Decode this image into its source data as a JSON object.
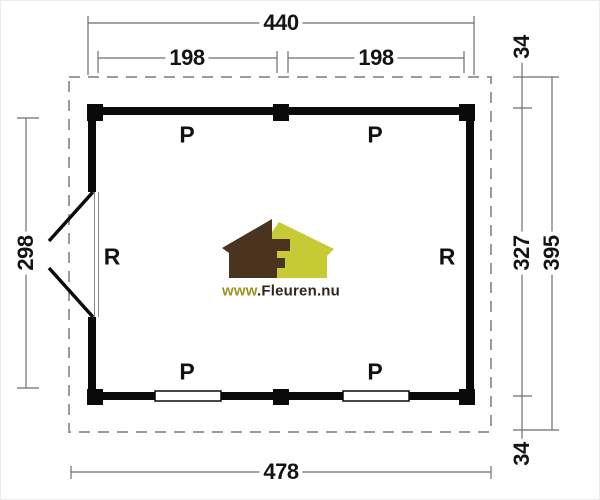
{
  "plan": {
    "dims": {
      "top_total": "440",
      "bay_left": "198",
      "bay_right": "198",
      "bottom_total": "478",
      "left_inner": "298",
      "right_overhang_top": "34",
      "right_wall": "327",
      "right_total": "395",
      "right_overhang_bottom": "34"
    },
    "labels": {
      "p_top_left": "P",
      "p_top_right": "P",
      "p_bottom_left": "P",
      "p_bottom_right": "P",
      "r_left": "R",
      "r_right": "R"
    }
  },
  "logo": {
    "www_part": "www",
    "domain_part": ".Fleuren.nu",
    "colors": {
      "house_dark": "#4a3420",
      "house_light": "#c6ca34",
      "www_text": "#99931f",
      "domain_text": "#30261b"
    }
  },
  "style_colors": {
    "wall": "#0a0a0a",
    "dimension_line": "#6e6e6e",
    "dimension_text": "#141414",
    "roof_dash": "#9b9b9b"
  }
}
